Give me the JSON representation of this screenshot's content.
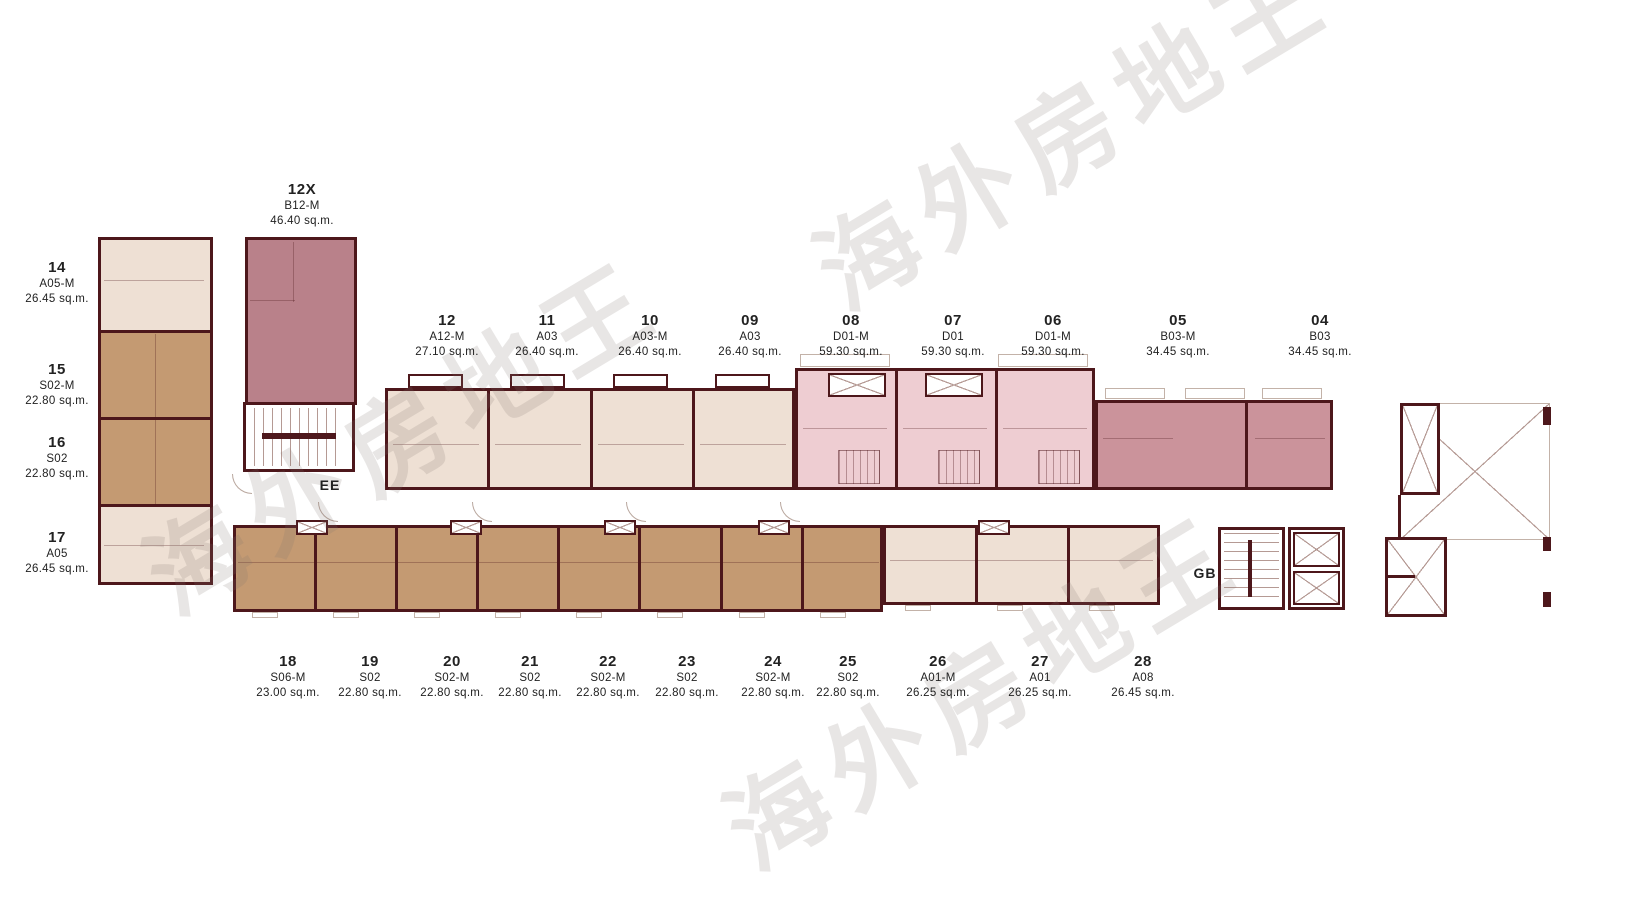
{
  "watermark": {
    "text": "海外房地王"
  },
  "zones": {
    "ee": "EE",
    "gb": "GB"
  },
  "colors": {
    "wall": "#4d171b",
    "beige_unit": "#eee0d4",
    "brown_unit": "#c49a72",
    "pink_unit": "#eecdd2",
    "rose_unit": "#cb939b",
    "mauve_unit": "#b9818a"
  },
  "units": [
    {
      "no": "12X",
      "type": "B12-M",
      "area": "46.40 sq.m."
    },
    {
      "no": "14",
      "type": "A05-M",
      "area": "26.45 sq.m."
    },
    {
      "no": "15",
      "type": "S02-M",
      "area": "22.80 sq.m."
    },
    {
      "no": "16",
      "type": "S02",
      "area": "22.80 sq.m."
    },
    {
      "no": "17",
      "type": "A05",
      "area": "26.45 sq.m."
    },
    {
      "no": "12",
      "type": "A12-M",
      "area": "27.10 sq.m."
    },
    {
      "no": "11",
      "type": "A03",
      "area": "26.40 sq.m."
    },
    {
      "no": "10",
      "type": "A03-M",
      "area": "26.40 sq.m."
    },
    {
      "no": "09",
      "type": "A03",
      "area": "26.40 sq.m."
    },
    {
      "no": "08",
      "type": "D01-M",
      "area": "59.30 sq.m."
    },
    {
      "no": "07",
      "type": "D01",
      "area": "59.30 sq.m."
    },
    {
      "no": "06",
      "type": "D01-M",
      "area": "59.30 sq.m."
    },
    {
      "no": "05",
      "type": "B03-M",
      "area": "34.45 sq.m."
    },
    {
      "no": "04",
      "type": "B03",
      "area": "34.45 sq.m."
    },
    {
      "no": "18",
      "type": "S06-M",
      "area": "23.00 sq.m."
    },
    {
      "no": "19",
      "type": "S02",
      "area": "22.80 sq.m."
    },
    {
      "no": "20",
      "type": "S02-M",
      "area": "22.80 sq.m."
    },
    {
      "no": "21",
      "type": "S02",
      "area": "22.80 sq.m."
    },
    {
      "no": "22",
      "type": "S02-M",
      "area": "22.80 sq.m."
    },
    {
      "no": "23",
      "type": "S02",
      "area": "22.80 sq.m."
    },
    {
      "no": "24",
      "type": "S02-M",
      "area": "22.80 sq.m."
    },
    {
      "no": "25",
      "type": "S02",
      "area": "22.80 sq.m."
    },
    {
      "no": "26",
      "type": "A01-M",
      "area": "26.25 sq.m."
    },
    {
      "no": "27",
      "type": "A01",
      "area": "26.25 sq.m."
    },
    {
      "no": "28",
      "type": "A08",
      "area": "26.45 sq.m."
    }
  ]
}
